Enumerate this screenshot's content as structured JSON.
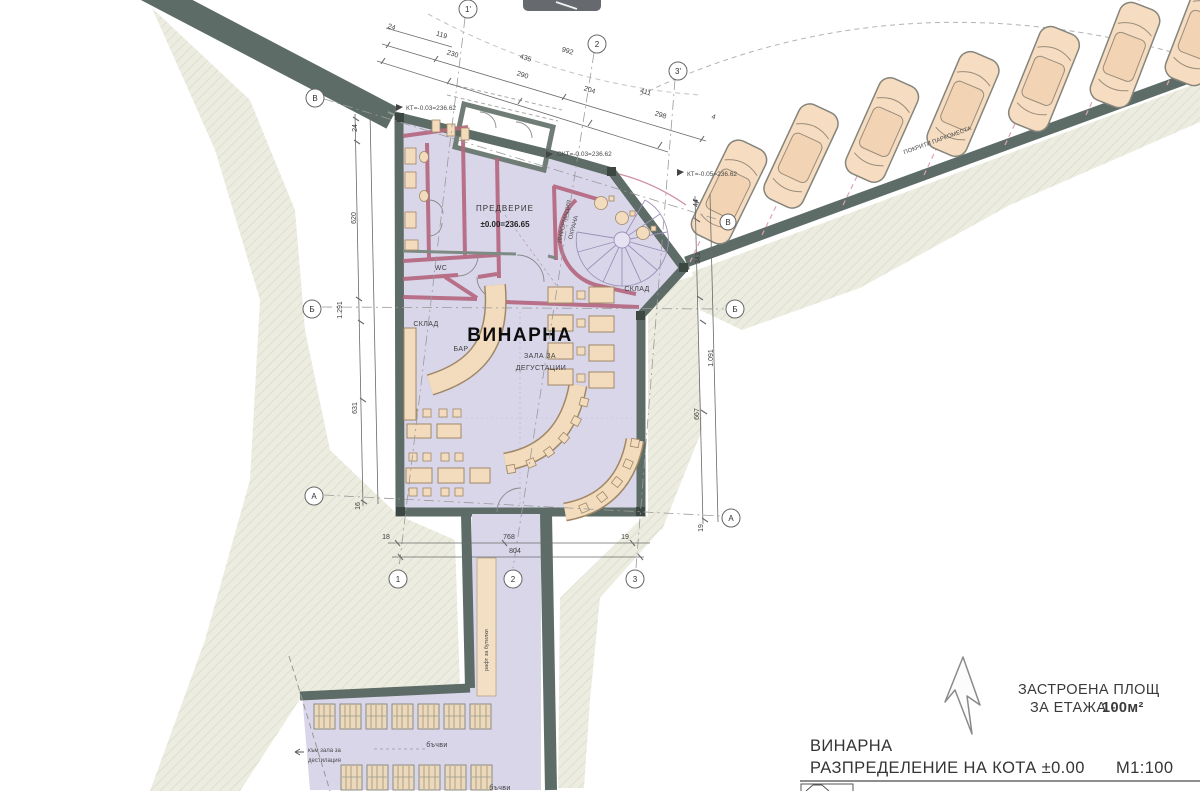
{
  "colors": {
    "wall": "#5d6c66",
    "room_fill": "#d9d6ea",
    "terrain": "#ecede0",
    "furniture": "#f3dcbd",
    "partition_pink": "#b5687f",
    "parking_dash_pink": "#e0a2b2",
    "car_body": "#f6dcc0",
    "line": "#6a6a6a"
  },
  "plan": {
    "dims": {
      "top": [
        "24",
        "119",
        "230",
        "435",
        "992",
        "290",
        "204",
        "411",
        "298",
        "4"
      ],
      "left": [
        "24",
        "620",
        "1.291",
        "631",
        "16"
      ],
      "right": [
        "44",
        "341",
        "1.091",
        "667",
        "19"
      ],
      "bottom": [
        "18",
        "768",
        "19",
        "804"
      ]
    },
    "axes": {
      "top": [
        "1'",
        "2",
        "3'"
      ],
      "left": [
        "В",
        "Б",
        "А"
      ],
      "right": [
        "Б",
        "А"
      ],
      "right_car": "В",
      "bottom": [
        "1",
        "2",
        "3"
      ]
    },
    "levels": {
      "kt_top": "КТ=-0.03=236.62",
      "skt": "СКТ=-0.03=236.62",
      "kt_right": "КТ=-0.05=236.62"
    },
    "rooms": {
      "vestibule": "ПРЕДВЕРИЕ",
      "vestibule_level": "±0.00=236.65",
      "wc": "WC",
      "info1": "ИНФОРМАЦИЯ",
      "info2": "ОХРАНА",
      "sklad_upper": "СКЛАД",
      "sklad_hall": "СКЛАД",
      "bar": "БАР",
      "hall": "ВИНАРНА",
      "hall_sub1": "ЗАЛА ЗА",
      "hall_sub2": "ДЕГУСТАЦИИ"
    },
    "cellar": {
      "barrels_row1": "бъчви",
      "barrels_row2": "бъчви",
      "dist1": "към зала за",
      "dist2": "дестилация",
      "shelf": "рафт за бутилки"
    },
    "parking_label": "ПОКРИТИ ПАРКОМЕСТА"
  },
  "legend": {
    "built1": "ЗАСТРОЕНА ПЛОЩ",
    "built2": "ЗА ЕТАЖА -",
    "built_value": "100м²",
    "title": "ВИНАРНА",
    "subtitle": "РАЗПРЕДЕЛЕНИЕ НА КОТА ±0.00",
    "scale": "М1:100"
  }
}
